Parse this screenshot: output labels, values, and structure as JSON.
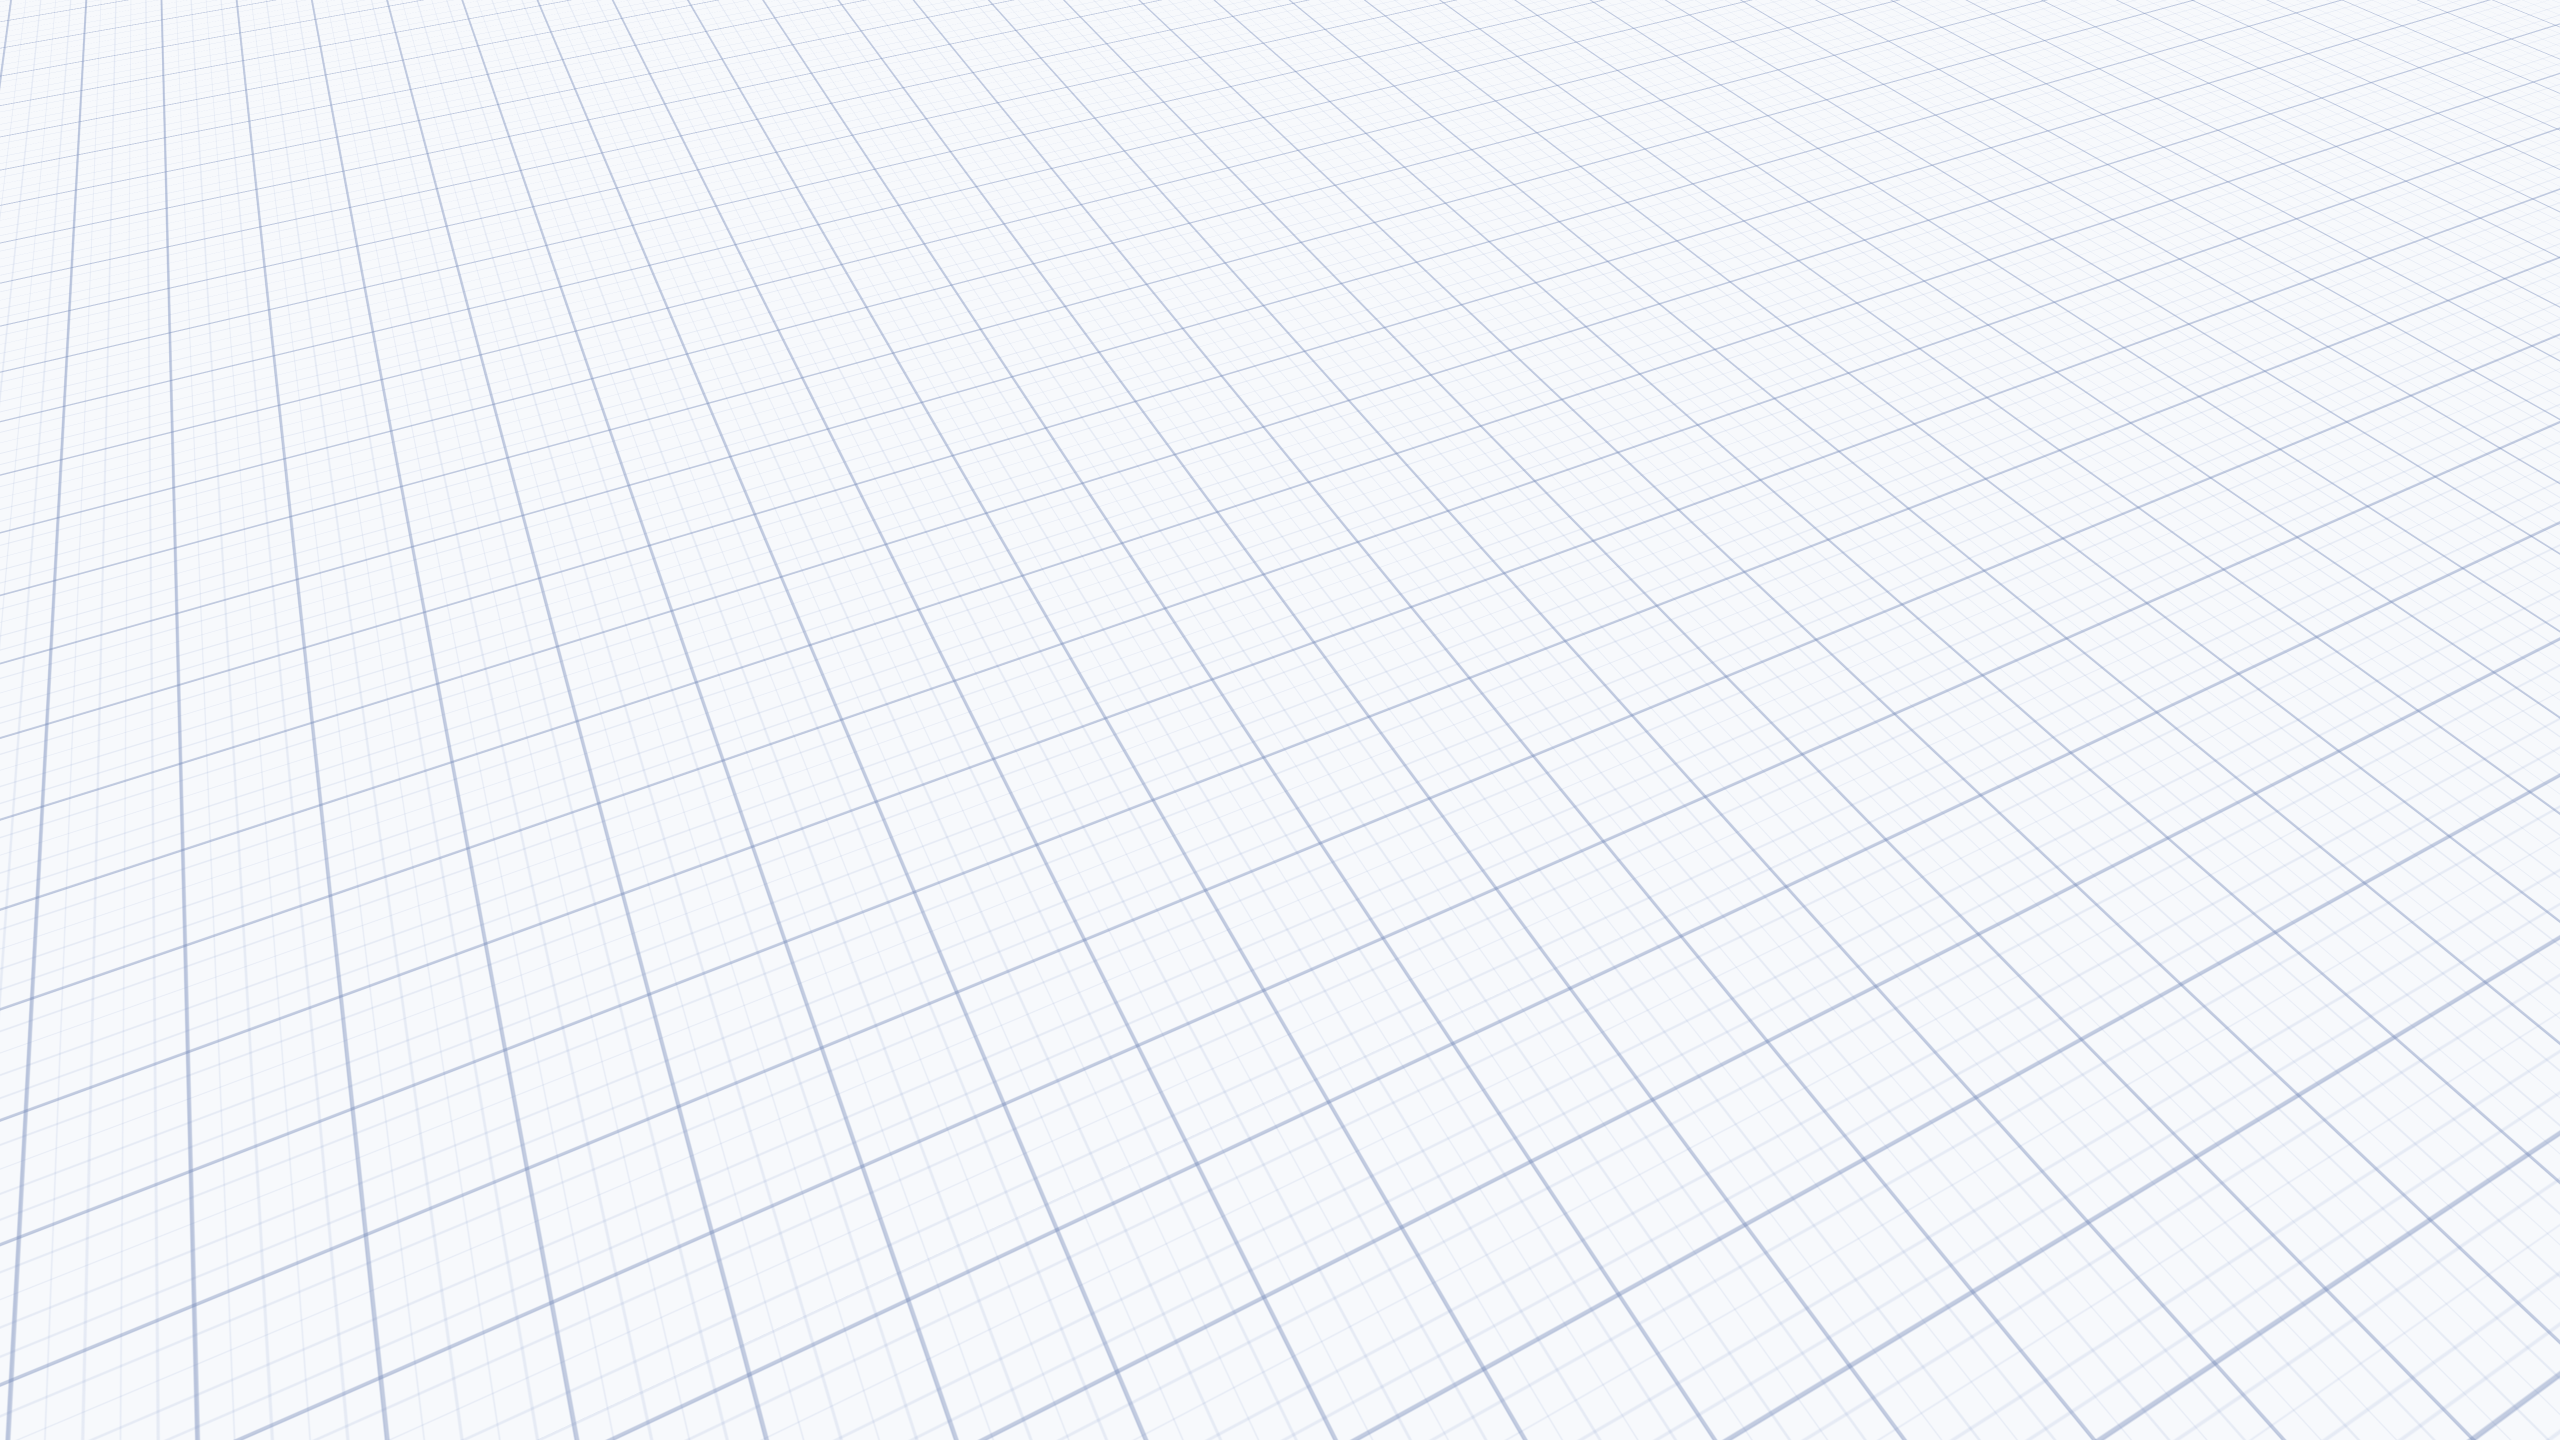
{
  "watermark": {
    "brand_text": "Planner",
    "logo_text": "5d"
  },
  "palette": {
    "background": "#eef2f8",
    "grid_major": "#7d8fb9",
    "grid_minor": "#8ca0cd",
    "wall_top": "#f8f8f6",
    "wall_dark": "#4a423c",
    "office_wall_navy": "#333d4b",
    "office_window_glass": "#2a3038",
    "desk_wood": "#c2a26f",
    "stairs_wood": "#d4ae66",
    "stairs_dark_wood": "#6e4d36",
    "floor_wood": "#b1a89d",
    "floor_gray": "#9c9892",
    "floor_bedroom": "#b3aca4",
    "rug_olive": "#6e6a55",
    "bed_linen": "#a99f98",
    "accent_plant": "#3f8f44",
    "accent_terrarium": "#39d98a",
    "accent_pot_red": "#ab4534",
    "sconce_glow": "#ffd9a0"
  },
  "scene": {
    "view": "isometric-3d-floor-plan",
    "background": "blueprint-grid-paper",
    "rooms": [
      {
        "name": "bedroom-upper",
        "furniture": [
          "double-bed",
          "striped-throw",
          "pillows",
          "nightstand",
          "terrarium",
          "wall-lamp",
          "tv-panel",
          "ceiling-spots",
          "light-rug"
        ]
      },
      {
        "name": "home-office",
        "furniture": [
          "wooden-desk",
          "laptop",
          "mouse",
          "tablet",
          "office-chair",
          "shag-rug",
          "potted-plant",
          "credenza",
          "window-slit",
          "open-door"
        ]
      },
      {
        "name": "living-hall",
        "furniture": [
          "open-staircase",
          "lower-stairs",
          "stair-railing",
          "round-wall-shelf",
          "wall-sconce",
          "wall-sconce",
          "coat-rack",
          "floor-lamp",
          "leaning-mirror",
          "door-to-bedroom",
          "area-rug"
        ]
      },
      {
        "name": "bedroom-lower",
        "furniture": [
          "double-bed",
          "quilted-duvet",
          "pillows",
          "glossy-headboard",
          "nightstand",
          "red-pot-plant",
          "sphere-lamp",
          "wardrobe",
          "leaning-tv",
          "ceiling-light",
          "wall-light-bar"
        ]
      }
    ]
  }
}
